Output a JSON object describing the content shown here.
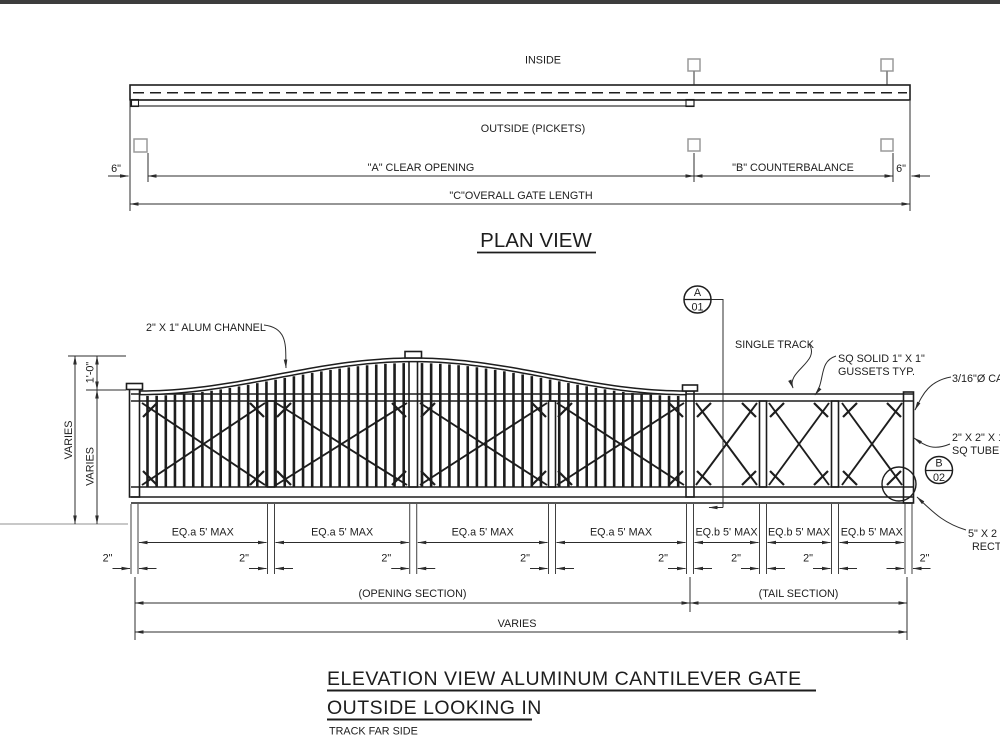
{
  "colors": {
    "background": "#ffffff",
    "line": "#1d1d1d",
    "dim_line": "#2c2c2c",
    "ground_line": "#b5b5b5",
    "guide_square": "#9a9a9a",
    "top_bar": "#3d3d3d"
  },
  "plan_view": {
    "inside_label": "INSIDE",
    "outside_label": "OUTSIDE (PICKETS)",
    "dim_6_left": "6\"",
    "dim_a_label": "\"A\" CLEAR OPENING",
    "dim_b_label": "\"B\" COUNTERBALANCE",
    "dim_6_right": "6\"",
    "dim_c_label": "\"C\"OVERALL GATE LENGTH",
    "title": "PLAN VIEW"
  },
  "elevation_view": {
    "annotations": {
      "alum_channel": "2\" X 1\" ALUM CHANNEL",
      "single_track": "SINGLE TRACK",
      "gussets_line_1": "SQ SOLID 1\" X 1\"",
      "gussets_line_2": "GUSSETS TYP.",
      "cable": "3/16\"Ø CA",
      "sq_tube_line_1": "2\" X 2\" X 1",
      "sq_tube_line_2": "SQ TUBE",
      "rect_tube_line_1": "5\" X 2",
      "rect_tube_line_2": "RECT"
    },
    "section_marker_a": {
      "letter": "A",
      "sheet": "01"
    },
    "section_marker_b": {
      "letter": "B",
      "sheet": "02"
    },
    "dims": {
      "overall_height": "VARIES",
      "arch_rise": "1'-0\"",
      "frame_height": "VARIES",
      "eq_a_labels": [
        "EQ.a 5' MAX",
        "EQ.a 5' MAX",
        "EQ.a 5' MAX",
        "EQ.a 5' MAX"
      ],
      "eq_b_labels": [
        "EQ.b 5' MAX",
        "EQ.b 5' MAX",
        "EQ.b 5' MAX"
      ],
      "post_width_labels": [
        "2\"",
        "2\"",
        "2\"",
        "2\"",
        "2\"",
        "2\"",
        "2\"",
        "2\""
      ],
      "opening_section_label": "(OPENING SECTION)",
      "tail_section_label": "(TAIL SECTION)",
      "overall_length": "VARIES"
    },
    "title_line_1": "ELEVATION VIEW ALUMINUM CANTILEVER GATE",
    "title_line_2": "OUTSIDE LOOKING IN",
    "note": "TRACK FAR SIDE"
  }
}
